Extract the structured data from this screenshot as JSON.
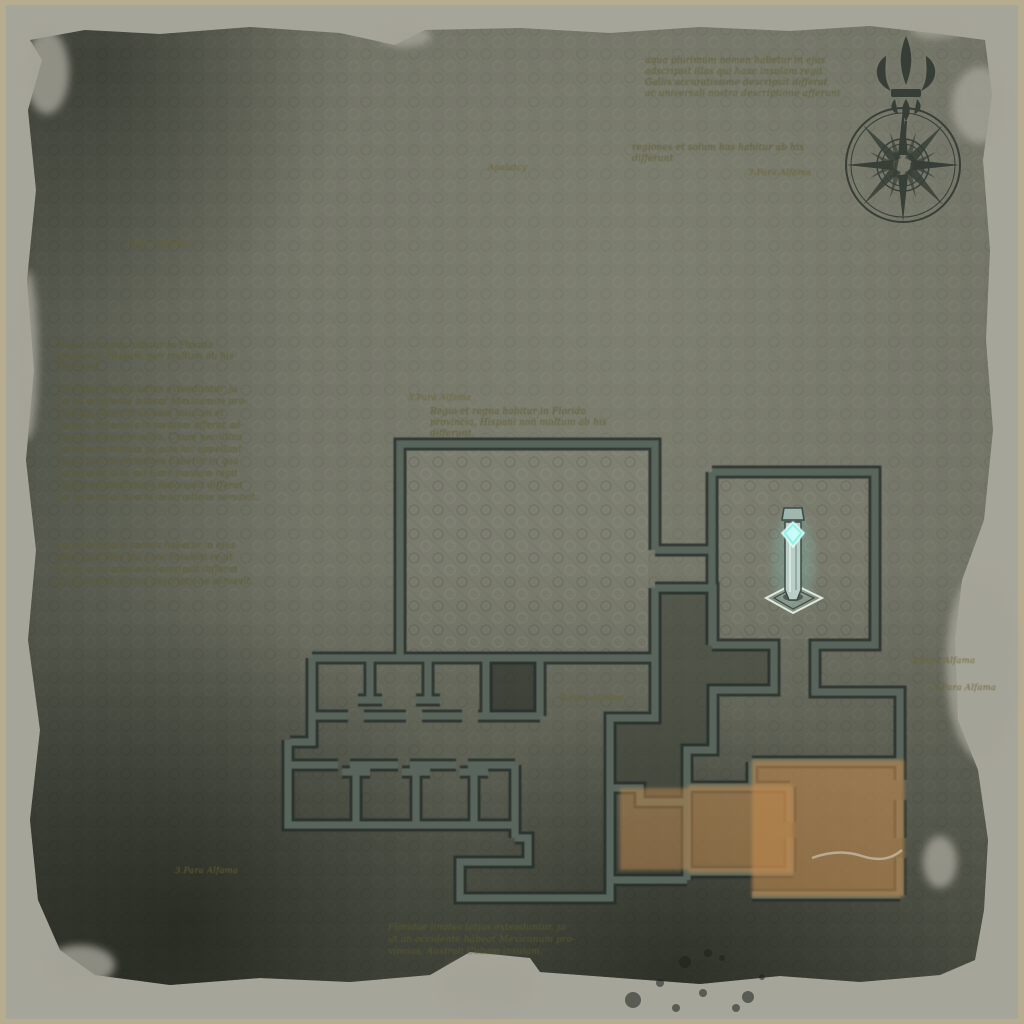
{
  "map": {
    "kind": "parchment-floorplan",
    "compass": {
      "monogram": "D"
    },
    "marker": {
      "name": "objective-shrine-marker",
      "x": 793,
      "y": 560
    },
    "highlights": [
      {
        "name": "highlight-room-left",
        "x": 620,
        "y": 788,
        "w": 68,
        "h": 82
      },
      {
        "name": "highlight-room-middle",
        "x": 688,
        "y": 785,
        "w": 105,
        "h": 88
      },
      {
        "name": "highlight-room-right",
        "x": 752,
        "y": 760,
        "w": 152,
        "h": 137
      }
    ]
  },
  "labels": {
    "place_labels": [
      {
        "text": "3.Para Alfama",
        "x": 125,
        "y": 246
      },
      {
        "text": "Apalatcy",
        "x": 488,
        "y": 170
      },
      {
        "text": "3.Para Alfama",
        "x": 748,
        "y": 175
      },
      {
        "text": "3.Para Alfama",
        "x": 408,
        "y": 400
      },
      {
        "text": "3.Para Alfama",
        "x": 560,
        "y": 700
      },
      {
        "text": "3.Para Alfama",
        "x": 912,
        "y": 663
      },
      {
        "text": "3.Para Alfama",
        "x": 933,
        "y": 690
      },
      {
        "text": "3.Para Alfama",
        "x": 175,
        "y": 873
      }
    ]
  },
  "annotations": {
    "blocks": [
      {
        "id": "note-top-center",
        "x": 645,
        "y": 63,
        "lh": 11,
        "lines": [
          "aqua plurimum nomen habetur in ejus",
          "adscripsit illas qui hanc insulam regit",
          "Gallis accuratissime descripsit differat",
          "ac universali nostra descriptione afferunt"
        ]
      },
      {
        "id": "note-top-center-small",
        "x": 632,
        "y": 150,
        "lh": 11,
        "lines": [
          "regiones et solum has habitur ab his",
          "differunt"
        ]
      },
      {
        "id": "note-left-upper",
        "x": 57,
        "y": 348,
        "lh": 11,
        "lines": [
          "Regio et regna habitur in Florida",
          "provincia, Hispani non multum ab his",
          "differunt."
        ]
      },
      {
        "id": "note-left-main",
        "x": 60,
        "y": 392,
        "lh": 12,
        "lines": [
          "Floridae limites latius extenduntur, ja",
          "ut ab occidente habeat Mexicanum pro-",
          "vincias, Australi Cubam insulam et",
          "facies, circumsis in medium afferat ad-",
          "mirum religione nulla. Unum nec ultra",
          "plurimum Florida pagum hic appellant",
          "aqua plurimum nomen habetur in qua",
          "adscripsit illas qui hanc insulam regit",
          "Gallis accuratissime descripsit differat",
          "ac universali nostra descriptione servavit."
        ]
      },
      {
        "id": "note-left-lower",
        "x": 55,
        "y": 548,
        "lh": 12,
        "lines": [
          "aqua plurimum nomen habetur in ejus",
          "adscripsit illas qui hanc insulam regit",
          "Gallis accuratissime descripsit differat",
          "ac universali nostra descriptione servavit."
        ]
      },
      {
        "id": "note-mid",
        "x": 430,
        "y": 414,
        "lh": 11,
        "lines": [
          "Regio et regna habitur in Florida",
          "provincia, Hispani non multum ab his",
          "differunt."
        ]
      },
      {
        "id": "note-bottom",
        "x": 388,
        "y": 930,
        "lh": 12,
        "lines": [
          "Floridae limites latius extenduntur, ja",
          "ut ab occidente habeat Mexicanum pro-",
          "vincias, Australi Cubam insulam."
        ]
      }
    ]
  },
  "colors": {
    "frame_tan": "#b6ac90",
    "paper_edge_light": "#a6a59a",
    "surface": "#70726400",
    "surface_fill": "#6f7164",
    "surface_dark": "#41463b",
    "wall_dark": "#272f29",
    "wall_core": "#5d6a62",
    "room_shade": "#3a3f35",
    "highlight_orange": "#c08a4e",
    "ink": "#2a322c",
    "label_olive": "#6b6530",
    "text_olive": "#5f5d31",
    "marker_cyan": "#8df0e6",
    "marker_body": "#b9cec6",
    "crack_light": "#cfcabc"
  }
}
